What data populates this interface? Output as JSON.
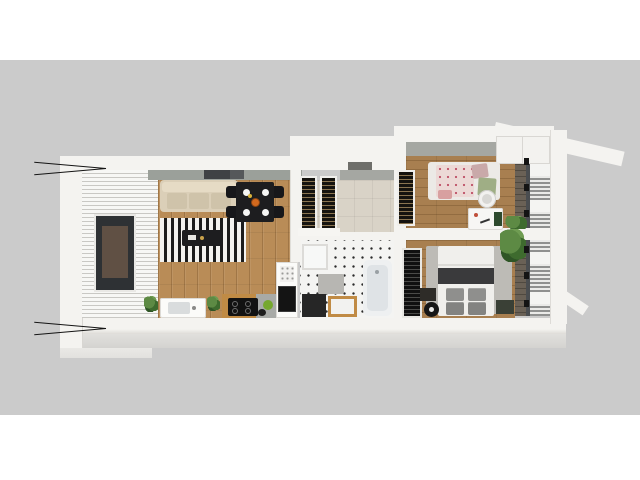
{
  "scene": {
    "type": "3d-floor-plan-render",
    "view": "top-down cutaway of a one-bedroom-plus-kids-room apartment",
    "visible_text": "none"
  },
  "palette": {
    "letterbox": "#ffffff",
    "backdrop": "#cbcbcb",
    "wall": "#f4f3f0",
    "wall_shade": "#dedcd8",
    "front_face": "#e2e1de",
    "ceiling": "#9ba09a",
    "ceiling_right": "#a5a7a2",
    "wood_living": "#b98c57",
    "wood_bedroom": "#a87f50",
    "wood_dark": "#6a6156",
    "deck_light": "#f7f7f5",
    "deck_dark": "#c9c8c4",
    "glass": "#2e3134",
    "glass_brown": "#8a6a52",
    "sofa": "#dbcfb8",
    "sofa_back": "#e6dbc5",
    "sofa_cushion": "#cfc3aa",
    "rug_light": "#f3f2ef",
    "rug_dark": "#1c1c1c",
    "table_black": "#1d1d1f",
    "chair_black": "#17171a",
    "plate": "#f5f5f3",
    "bowl_orange": "#d2691e",
    "tile_hall": "#d9d3c7",
    "tile_bath": "#f4f4f2",
    "dot": "#2b2b2b",
    "tub": "#eef0f1",
    "tub_inner": "#dfe3e6",
    "counter_wood": "#c08b45",
    "counter_gray": "#a8aaa7",
    "cooktop": "#121212",
    "appliance": "#fbfbf9",
    "oven": "#141414",
    "shelf_dark": "#15130f",
    "shelf_spines": "#8a7450",
    "closet_dark": "#101010",
    "closet_lines": "#4a4a48",
    "rug_master": "#bdbbb6",
    "bed_white": "#f0efec",
    "bed_band": "#3a3a3c",
    "pillow_gray": "#8f8f8d",
    "duvet_pink": "#ecd9d6",
    "duvet_dot": "#c0566a",
    "pillow_green": "#9fae85",
    "pillow_mauve": "#c9a9a9",
    "plant_green": "#4e7a3a",
    "plant_dark": "#2e4a2e",
    "blinds_light": "#eaeae8",
    "blinds_dark": "#8f908f",
    "line_black": "#141414",
    "door_gray": "#6e6e6a",
    "tv_gray": "#3f4245",
    "lamp_black": "#161616"
  },
  "rooms": [
    {
      "id": "balcony",
      "features": [
        "slatted-deck",
        "glass-roof-panel",
        "awning-arms"
      ]
    },
    {
      "id": "living-room",
      "features": [
        "beige-sofa",
        "striped-rug",
        "coffee-table",
        "window-blinds"
      ]
    },
    {
      "id": "dining-area",
      "features": [
        "black-table",
        "four-chairs",
        "four-plates",
        "orange-bowl"
      ]
    },
    {
      "id": "kitchen",
      "features": [
        "sink-unit",
        "island-with-cooktop",
        "oven-column",
        "plants"
      ]
    },
    {
      "id": "hallway",
      "features": [
        "bookshelves",
        "entry-door",
        "tile-floor"
      ]
    },
    {
      "id": "bathroom",
      "features": [
        "bathtub",
        "shower-unit",
        "wood-vanity",
        "laundry-unit",
        "bath-mat"
      ]
    },
    {
      "id": "closet",
      "features": [
        "dark-shelving"
      ]
    },
    {
      "id": "master-bedroom",
      "features": [
        "double-bed",
        "gray-rug",
        "nightstands",
        "floor-lamp",
        "tall-plant",
        "window-blinds"
      ]
    },
    {
      "id": "kids-bedroom",
      "features": [
        "single-bed",
        "patterned-duvet",
        "desk",
        "round-chair",
        "wardrobe",
        "plants",
        "window-blinds"
      ]
    }
  ]
}
